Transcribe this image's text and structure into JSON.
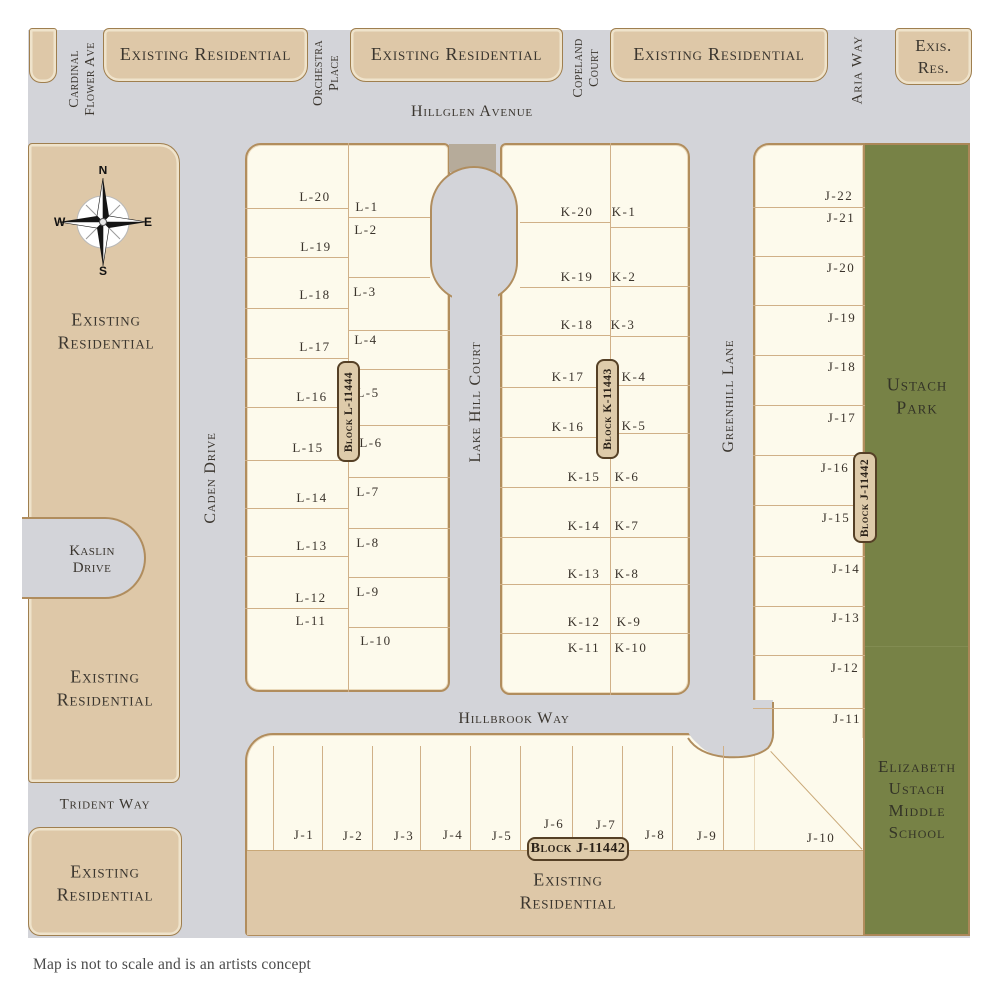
{
  "footer": "Map is not to scale and is an artists concept",
  "colors": {
    "road": "#d3d4d9",
    "parcel": "#fdfaec",
    "parcel_border": "#b18d5d",
    "tan": "#dec8a8",
    "tan_border": "#9f7f4f",
    "green": "#778246",
    "walkway": "#b6ab9a",
    "lot_line": "#d0b088",
    "badge_fill": "#decbaa",
    "badge_border": "#554026",
    "text": "#3b362f"
  },
  "compass": {
    "n": "N",
    "e": "E",
    "s": "S",
    "w": "W"
  },
  "top_boxes": {
    "box1_label": "Existing Residential",
    "box2_label": "Existing Residential",
    "box3_label": "Existing Residential",
    "box4_line1": "Exis.",
    "box4_line2": "Res."
  },
  "streets": {
    "hillglen": "Hillglen Avenue",
    "hillbrook": "Hillbrook Way",
    "trident": "Trident Way",
    "caden": "Caden Drive",
    "lakehill": "Lake Hill Court",
    "greenhill": "Greenhill Lane",
    "aria": "Aria Way",
    "kaslin_line1": "Kaslin",
    "kaslin_line2": "Drive",
    "cardinal_line1": "Cardinal",
    "cardinal_line2": "Flower Ave",
    "orchestra_line1": "Orchestra",
    "orchestra_line2": "Place",
    "copeland_line1": "Copeland",
    "copeland_line2": "Court"
  },
  "areas": {
    "upper_left_line1": "Existing",
    "upper_left_line2": "Residential",
    "mid_left_line1": "Existing",
    "mid_left_line2": "Residential",
    "lower_left_line1": "Existing",
    "lower_left_line2": "Residential",
    "bottom_line1": "Existing",
    "bottom_line2": "Residential",
    "park_line1": "Ustach",
    "park_line2": "Park",
    "school_line1": "Elizabeth",
    "school_line2": "Ustach",
    "school_line3": "Middle",
    "school_line4": "School"
  },
  "badges": {
    "block_l": "Block L-11444",
    "block_k": "Block K-11443",
    "block_j_vertical": "Block J-11442",
    "block_j_horizontal": "Block J-11442"
  },
  "lots": {
    "block_l_west": [
      {
        "t": "L-20",
        "x": 315,
        "y": 197
      },
      {
        "t": "L-19",
        "x": 316,
        "y": 247
      },
      {
        "t": "L-18",
        "x": 315,
        "y": 295
      },
      {
        "t": "L-17",
        "x": 315,
        "y": 347
      },
      {
        "t": "L-16",
        "x": 312,
        "y": 397
      },
      {
        "t": "L-15",
        "x": 308,
        "y": 448
      },
      {
        "t": "L-14",
        "x": 312,
        "y": 498
      },
      {
        "t": "L-13",
        "x": 312,
        "y": 546
      },
      {
        "t": "L-12",
        "x": 311,
        "y": 598
      },
      {
        "t": "L-11",
        "x": 311,
        "y": 621
      }
    ],
    "block_l_east": [
      {
        "t": "L-1",
        "x": 367,
        "y": 207
      },
      {
        "t": "L-2",
        "x": 366,
        "y": 230
      },
      {
        "t": "L-3",
        "x": 365,
        "y": 292
      },
      {
        "t": "L-4",
        "x": 366,
        "y": 340
      },
      {
        "t": "L-5",
        "x": 368,
        "y": 393
      },
      {
        "t": "L-6",
        "x": 371,
        "y": 443
      },
      {
        "t": "L-7",
        "x": 368,
        "y": 492
      },
      {
        "t": "L-8",
        "x": 368,
        "y": 543
      },
      {
        "t": "L-9",
        "x": 368,
        "y": 592
      },
      {
        "t": "L-10",
        "x": 376,
        "y": 641
      }
    ],
    "block_k_west": [
      {
        "t": "K-20",
        "x": 577,
        "y": 212
      },
      {
        "t": "K-19",
        "x": 577,
        "y": 277
      },
      {
        "t": "K-18",
        "x": 577,
        "y": 325
      },
      {
        "t": "K-17",
        "x": 568,
        "y": 377
      },
      {
        "t": "K-16",
        "x": 568,
        "y": 427
      },
      {
        "t": "K-15",
        "x": 584,
        "y": 477
      },
      {
        "t": "K-14",
        "x": 584,
        "y": 526
      },
      {
        "t": "K-13",
        "x": 584,
        "y": 574
      },
      {
        "t": "K-12",
        "x": 584,
        "y": 622
      },
      {
        "t": "K-11",
        "x": 584,
        "y": 648
      }
    ],
    "block_k_east": [
      {
        "t": "K-1",
        "x": 624,
        "y": 212
      },
      {
        "t": "K-2",
        "x": 624,
        "y": 277
      },
      {
        "t": "K-3",
        "x": 623,
        "y": 325
      },
      {
        "t": "K-4",
        "x": 634,
        "y": 377
      },
      {
        "t": "K-5",
        "x": 634,
        "y": 426
      },
      {
        "t": "K-6",
        "x": 627,
        "y": 477
      },
      {
        "t": "K-7",
        "x": 627,
        "y": 526
      },
      {
        "t": "K-8",
        "x": 627,
        "y": 574
      },
      {
        "t": "K-9",
        "x": 629,
        "y": 622
      },
      {
        "t": "K-10",
        "x": 631,
        "y": 648
      }
    ],
    "block_j_east": [
      {
        "t": "J-22",
        "x": 839,
        "y": 196
      },
      {
        "t": "J-21",
        "x": 841,
        "y": 218
      },
      {
        "t": "J-20",
        "x": 841,
        "y": 268
      },
      {
        "t": "J-19",
        "x": 842,
        "y": 318
      },
      {
        "t": "J-18",
        "x": 842,
        "y": 367
      },
      {
        "t": "J-17",
        "x": 842,
        "y": 418
      },
      {
        "t": "J-16",
        "x": 835,
        "y": 468
      },
      {
        "t": "J-15",
        "x": 836,
        "y": 518
      },
      {
        "t": "J-14",
        "x": 846,
        "y": 569
      },
      {
        "t": "J-13",
        "x": 846,
        "y": 618
      },
      {
        "t": "J-12",
        "x": 845,
        "y": 668
      },
      {
        "t": "J-11",
        "x": 847,
        "y": 719
      }
    ],
    "block_j_south": [
      {
        "t": "J-1",
        "x": 304,
        "y": 835
      },
      {
        "t": "J-2",
        "x": 353,
        "y": 836
      },
      {
        "t": "J-3",
        "x": 404,
        "y": 836
      },
      {
        "t": "J-4",
        "x": 453,
        "y": 835
      },
      {
        "t": "J-5",
        "x": 502,
        "y": 836
      },
      {
        "t": "J-6",
        "x": 554,
        "y": 824
      },
      {
        "t": "J-7",
        "x": 606,
        "y": 825
      },
      {
        "t": "J-8",
        "x": 655,
        "y": 835
      },
      {
        "t": "J-9",
        "x": 707,
        "y": 836
      },
      {
        "t": "J-10",
        "x": 821,
        "y": 838
      }
    ]
  }
}
